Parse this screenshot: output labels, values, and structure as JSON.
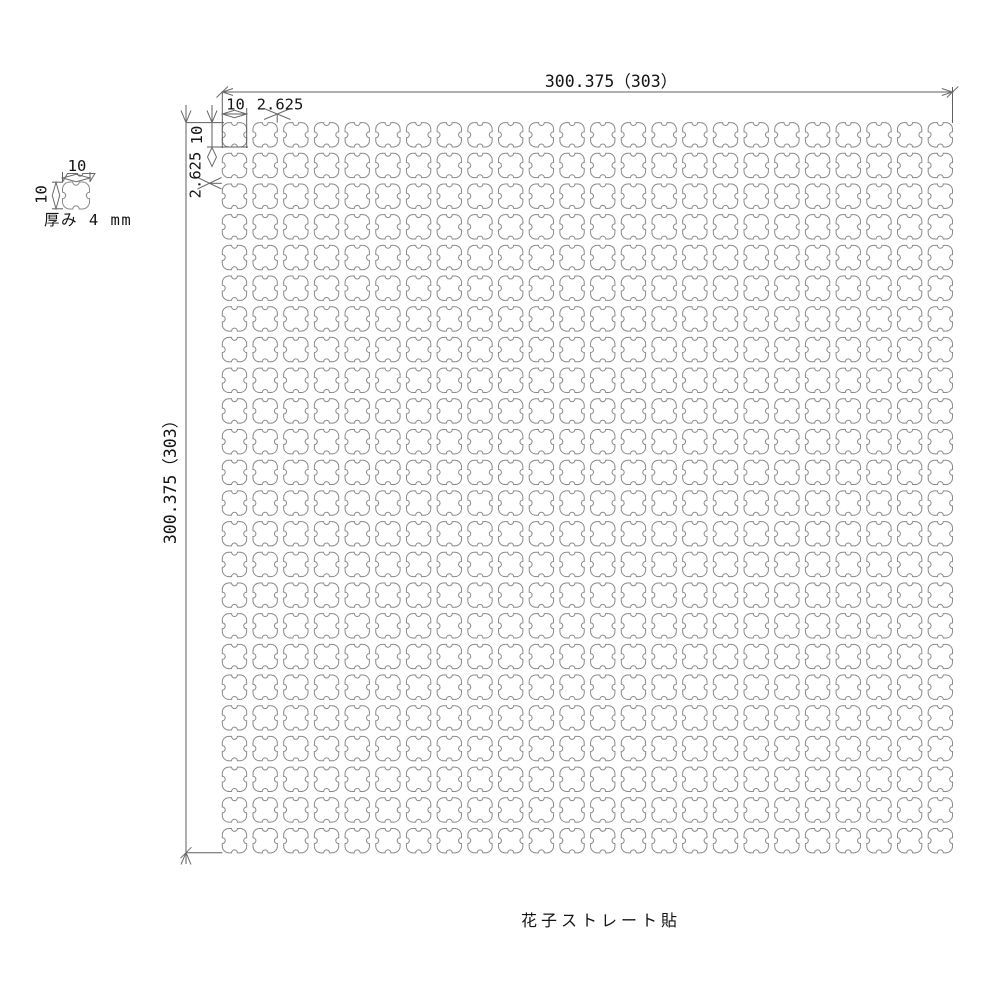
{
  "drawing": {
    "sheet": {
      "top_dimension": "300.375（303）",
      "left_dimension": "300.375（303）",
      "tile_width": "10",
      "joint_width": "2.625",
      "tile_height": "10",
      "joint_height": "2.625"
    },
    "detail": {
      "width": "10",
      "height": "10",
      "thickness_note": "厚み 4 mm"
    },
    "caption": "花子ストレート貼",
    "grid": {
      "rows": 24,
      "cols": 24
    },
    "colors": {
      "background": "#ffffff",
      "tile_stroke": "#8a8a8a",
      "dimension_stroke": "#5f5f5f",
      "text": "#141414"
    }
  }
}
